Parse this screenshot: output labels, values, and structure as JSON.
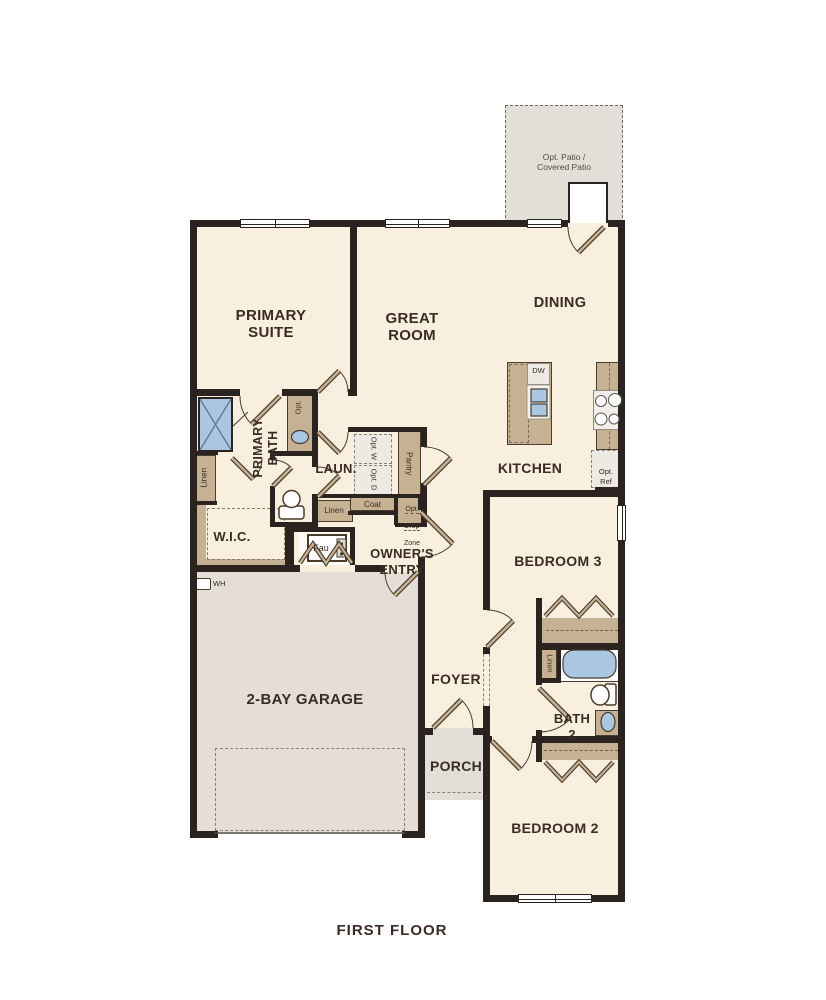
{
  "title": "FIRST FLOOR",
  "rooms": {
    "patio": {
      "line1": "Opt. Patio /",
      "line2": "Covered Patio"
    },
    "primary_suite": {
      "line1": "PRIMARY",
      "line2": "SUITE"
    },
    "great_room": {
      "line1": "GREAT",
      "line2": "ROOM"
    },
    "dining": "DINING",
    "kitchen": "KITCHEN",
    "primary_bath": {
      "line1": "PRIMARY",
      "line2": "BATH"
    },
    "laundry": "LAUN.",
    "wic": "W.I.C.",
    "owners_entry": {
      "line1": "OWNER'S",
      "line2": "ENTRY"
    },
    "garage": "2-BAY GARAGE",
    "foyer": "FOYER",
    "porch": "PORCH",
    "bedroom3": "BEDROOM 3",
    "bath2": {
      "line1": "BATH",
      "line2": "2"
    },
    "bedroom2": "BEDROOM 2"
  },
  "fixtures": {
    "dw": "DW",
    "opt_ref": {
      "line1": "Opt.",
      "line2": "Ref"
    },
    "opt_w": "Opt. W",
    "opt_d": "Opt. D",
    "pantry": "Pantry",
    "coat": "Coat",
    "drop_zone": {
      "line1": "Opt.",
      "line2": "Drop",
      "line3": "Zone"
    },
    "linen": "Linen",
    "fau": "Fau",
    "opt": "Opt.",
    "wh": "WH"
  },
  "colors": {
    "wall": "#2b2320",
    "floor": "#f8efde",
    "garage": "#e4ded6",
    "patio": "#e2ded8",
    "cabinet": "#c6b292",
    "fixture": "#a9c7e1",
    "text": "#3a2c24"
  }
}
